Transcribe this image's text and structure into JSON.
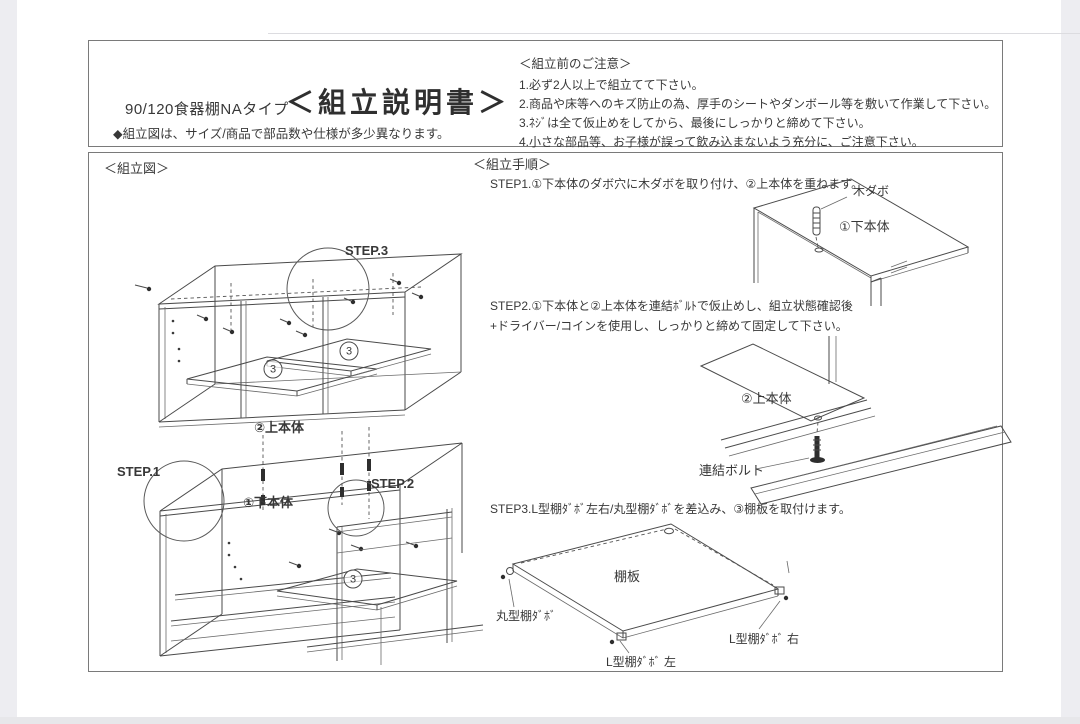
{
  "header": {
    "product_name": "90/120食器棚NAタイプ",
    "doc_title": "＜組立説明書＞",
    "size_note": "◆組立図は、サイズ/商品で部品数や仕様が多少異なります。",
    "precautions": {
      "title": "＜組立前のご注意＞",
      "items": [
        "1.必ず2人以上で組立てて下さい。",
        "2.商品や床等へのキズ防止の為、厚手のシートやダンボール等を敷いて作業して下さい。",
        "3.ﾈｼﾞは全て仮止めをしてから、最後にしっかりと締めて下さい。",
        "4.小さな部品等、お子様が誤って飲み込まないよう充分に、ご注意下さい。"
      ]
    }
  },
  "figure": {
    "section_title": "＜組立図＞",
    "step1_label": "STEP.1",
    "step2_label": "STEP.2",
    "step3_label": "STEP.3",
    "upper_body_label": "②上本体",
    "lower_body_label": "①下本体",
    "shelf_mark_digit": "3"
  },
  "procedure": {
    "section_title": "＜組立手順＞",
    "step1": {
      "text": "STEP1.①下本体のダボ穴に木ダボを取り付け、②上本体を重ねます。",
      "wood_dowel_label": "木ダボ",
      "lower_body_label": "①下本体"
    },
    "step2": {
      "text_line1": "STEP2.①下本体と②上本体を連結ﾎﾞﾙﾄで仮止めし、組立状態確認後",
      "text_line2": "+ドライバー/コインを使用し、しっかりと締めて固定して下さい。",
      "upper_body_label": "②上本体",
      "bolt_label": "連結ボルト"
    },
    "step3": {
      "text": "STEP3.L型棚ﾀﾞﾎﾞ左右/丸型棚ﾀﾞﾎﾞを差込み、③棚板を取付けます。",
      "shelf_label": "棚板",
      "round_dowel_label": "丸型棚ﾀﾞﾎﾞ",
      "l_dowel_left_label": "L型棚ﾀﾞﾎﾞ 左",
      "l_dowel_right_label": "L型棚ﾀﾞﾎﾞ 右"
    }
  },
  "colors": {
    "line": "#4a4a4a",
    "text": "#383838",
    "border": "#7a7a7a",
    "edge_strip": "#ededf1"
  }
}
